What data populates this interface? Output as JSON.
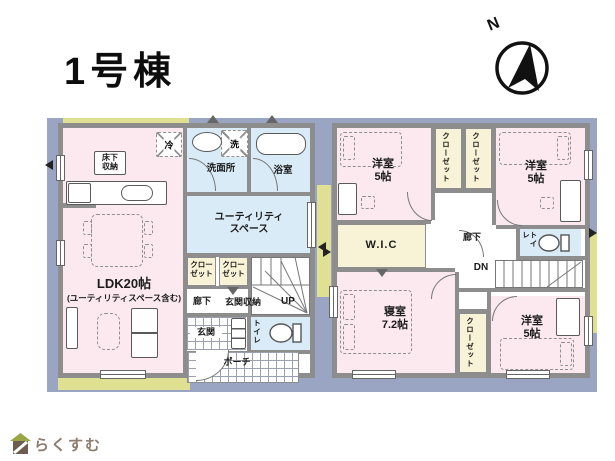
{
  "title": "1号棟",
  "compass": {
    "north": "N"
  },
  "footer": {
    "logo": "らくすむ"
  },
  "colors": {
    "backdrop": "#9aa5c3",
    "accent_green": "#dfe092",
    "room_pink": "#fbe9ef",
    "room_blue": "#d8ebf6",
    "closet_yellow": "#f8f3d6",
    "wall_gray": "#8d8d8d",
    "logo_text": "#8d7b6e",
    "logo_roof": "#9aa643",
    "logo_body": "#6e5c50"
  },
  "floor1": {
    "ldk": "LDK20帖",
    "ldk_note": "(ユーティリティスペース含む)",
    "underfloor": "床下\n収納",
    "fridge": "冷",
    "washer": "洗",
    "washroom": "洗面所",
    "bathroom": "浴室",
    "utility": "ユーティリティ\nスペース",
    "closet_a": "クロー\nゼット",
    "closet_b": "クロー\nゼット",
    "hallway": "廊下",
    "entrance_storage": "玄関収納",
    "up": "UP",
    "entrance": "玄関",
    "toilet": "トイレ",
    "porch": "ポーチ"
  },
  "floor2": {
    "west_a": "洋室\n5帖",
    "west_b": "洋室\n5帖",
    "west_c": "洋室\n5帖",
    "closet_a": "クローゼット",
    "closet_b": "クローゼット",
    "closet_c": "クローゼット",
    "wic": "W.I.C",
    "hallway": "廊下",
    "toilet": "トイレ",
    "dn": "DN",
    "master": "寝室\n7.2帖"
  }
}
